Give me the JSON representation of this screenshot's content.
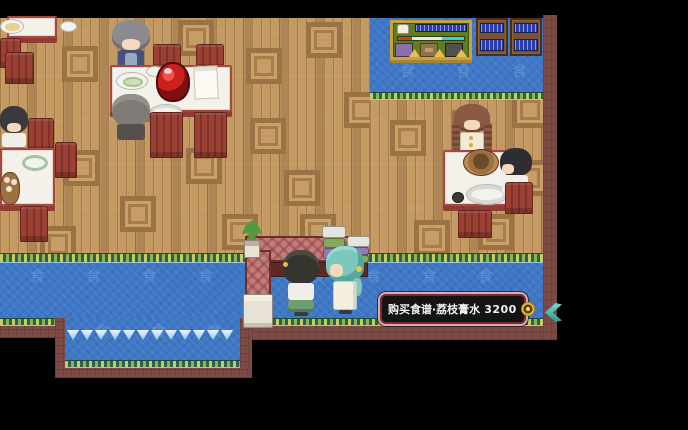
{
  "tooltip": {
    "label": "购买食谱·荔枝膏水",
    "price": "3200"
  },
  "carpet": {
    "glyph": "食"
  },
  "icons": {
    "coin": "coin-icon",
    "exit_arrow": "chevron-left-icon"
  },
  "colors": {
    "carpet_blue": "#3e77c5",
    "wood_floor": "#c49a62",
    "wall_maroon": "#7c4a45",
    "accent_teal": "#49c7ba",
    "tooltip_border": "#e0a8b2",
    "coin_gold": "#f0c344",
    "chair_red": "#9c4033",
    "table_trim": "#a8473f",
    "board_green": "#5f7d1e",
    "book_blue": "#2b3daa"
  }
}
